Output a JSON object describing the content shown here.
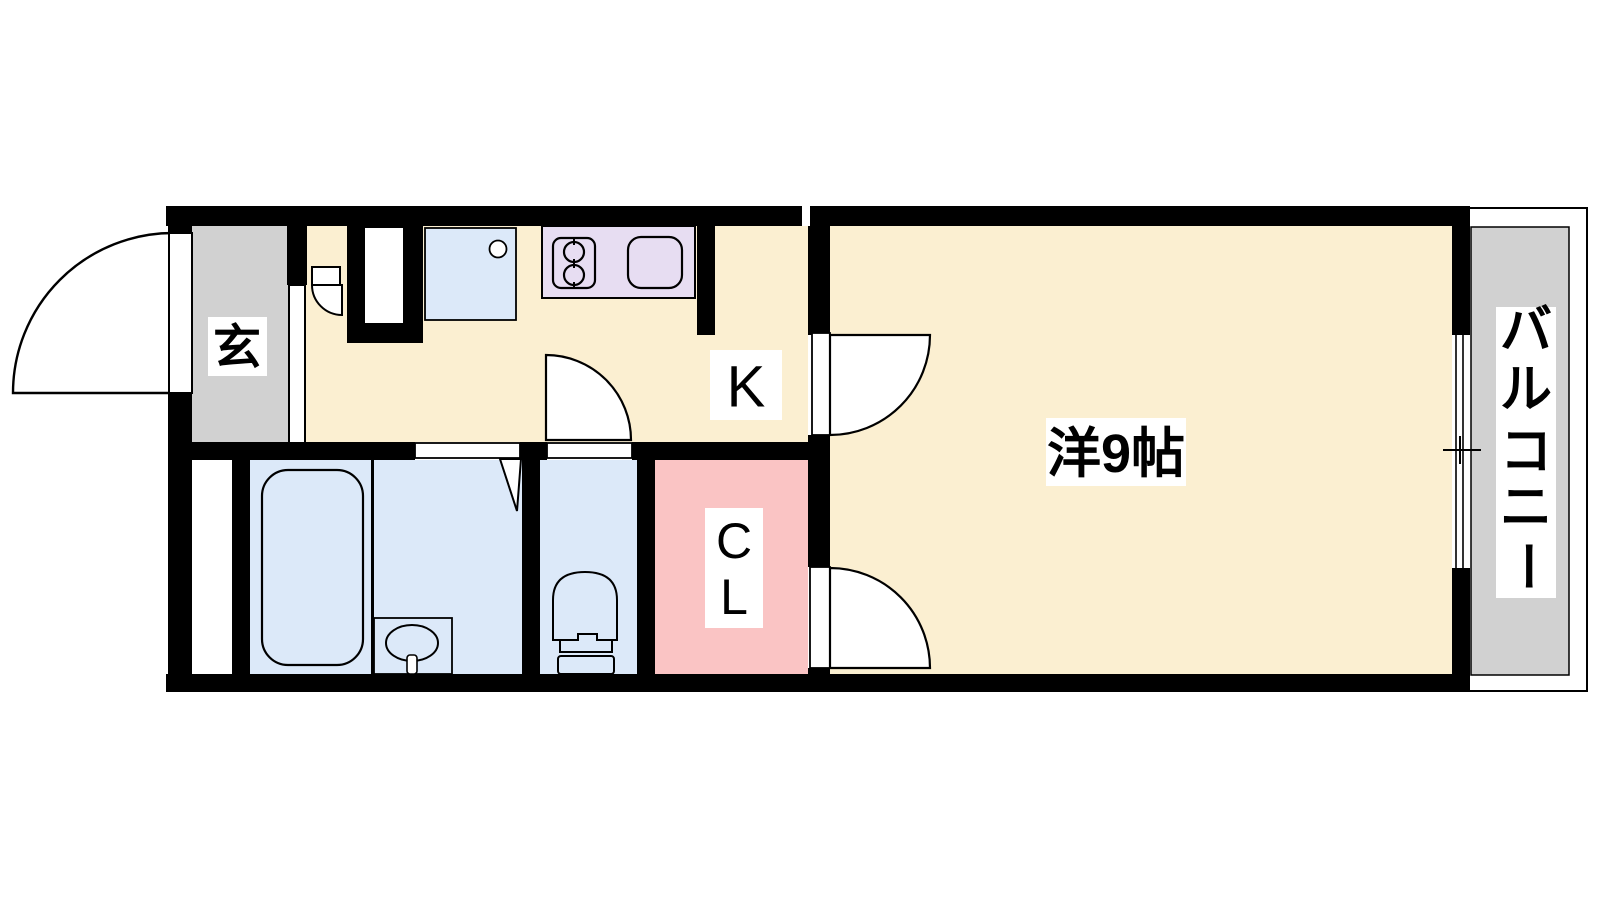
{
  "floorplan": {
    "type": "japanese-apartment-1K",
    "rooms": {
      "entrance": {
        "label": "玄"
      },
      "kitchen": {
        "label": "K"
      },
      "western_room": {
        "label": "洋9帖"
      },
      "closet": {
        "label_char1": "C",
        "label_char2": "L"
      },
      "balcony": {
        "label": "バルコニー",
        "chars": [
          "バ",
          "ル",
          "コ",
          "ニ",
          "ー"
        ]
      }
    },
    "fixtures": [
      "entrance-door",
      "shoe-cupboard-door",
      "washing-machine-pan",
      "kitchen-counter",
      "stove-2-burner",
      "sink",
      "bathtub",
      "washbasin",
      "toilet",
      "folding-door",
      "hinged-doors",
      "sliding-window"
    ],
    "colors": {
      "wall": "#000000",
      "floor": "#fbefd1",
      "gray": "#d1d1d1",
      "blue": "#dce9f9",
      "purple": "#e7ddf2",
      "pink": "#fac4c4",
      "white": "#ffffff",
      "line": "#000000"
    }
  }
}
